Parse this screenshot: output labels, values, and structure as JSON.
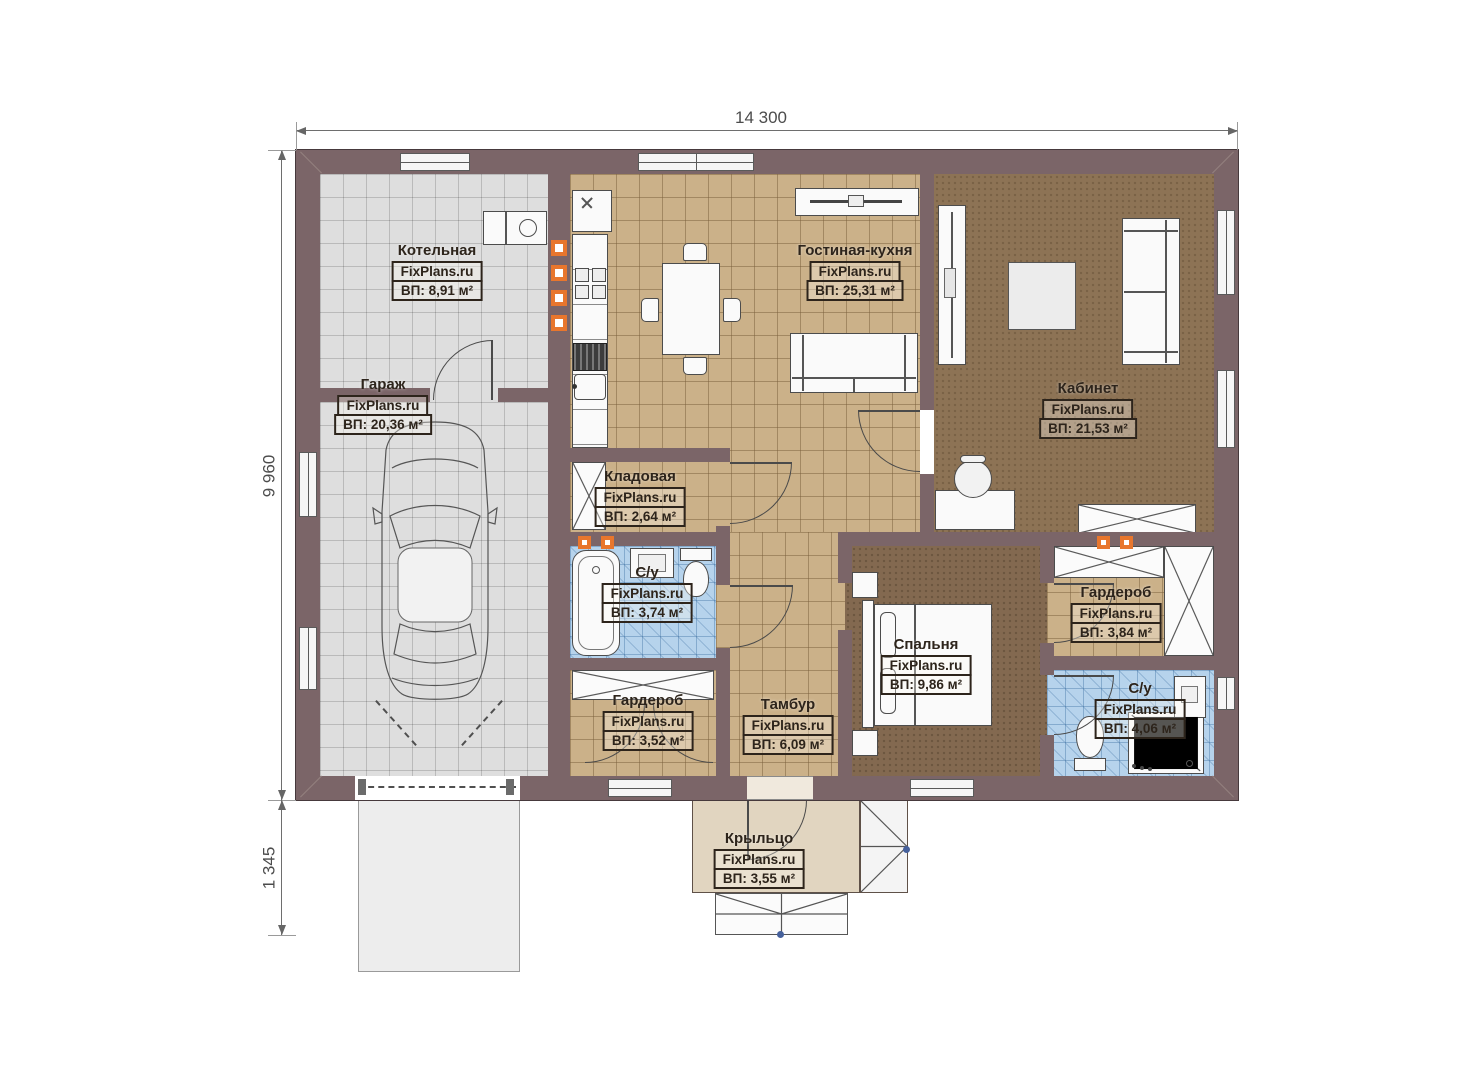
{
  "watermark": "FixPlans.ru",
  "dimensions": {
    "overall_width": "14 300",
    "overall_depth": "9 960",
    "porch_depth": "1 345"
  },
  "rooms": [
    {
      "id": "boiler",
      "name": "Котельная",
      "area": "ВП: 8,91 м²"
    },
    {
      "id": "garage",
      "name": "Гараж",
      "area": "ВП: 20,36 м²"
    },
    {
      "id": "living",
      "name": "Гостиная-кухня",
      "area": "ВП: 25,31 м²"
    },
    {
      "id": "office",
      "name": "Кабинет",
      "area": "ВП: 21,53 м²"
    },
    {
      "id": "storage",
      "name": "Кладовая",
      "area": "ВП: 2,64 м²"
    },
    {
      "id": "bath1",
      "name": "С/у",
      "area": "ВП: 3,74 м²"
    },
    {
      "id": "wardrobe1",
      "name": "Гардероб",
      "area": "ВП: 3,52 м²"
    },
    {
      "id": "tambour",
      "name": "Тамбур",
      "area": "ВП: 6,09 м²"
    },
    {
      "id": "bedroom",
      "name": "Спальня",
      "area": "ВП: 9,86 м²"
    },
    {
      "id": "wardrobe2",
      "name": "Гардероб",
      "area": "ВП: 3,84 м²"
    },
    {
      "id": "bath2",
      "name": "С/у",
      "area": "ВП: 4,06 м²"
    },
    {
      "id": "porch",
      "name": "Крыльцо",
      "area": "ВП: 3,55 м²"
    }
  ],
  "colors": {
    "wall": "#7b6568",
    "tile_gray": "#dedede",
    "tile_beige": "#cbb189",
    "tile_blue": "#b6d3ec",
    "floor_office": "#8d7355",
    "floor_bedroom": "#836950",
    "porch": "#e1d5c0",
    "vent_marker": "#e8762d"
  }
}
